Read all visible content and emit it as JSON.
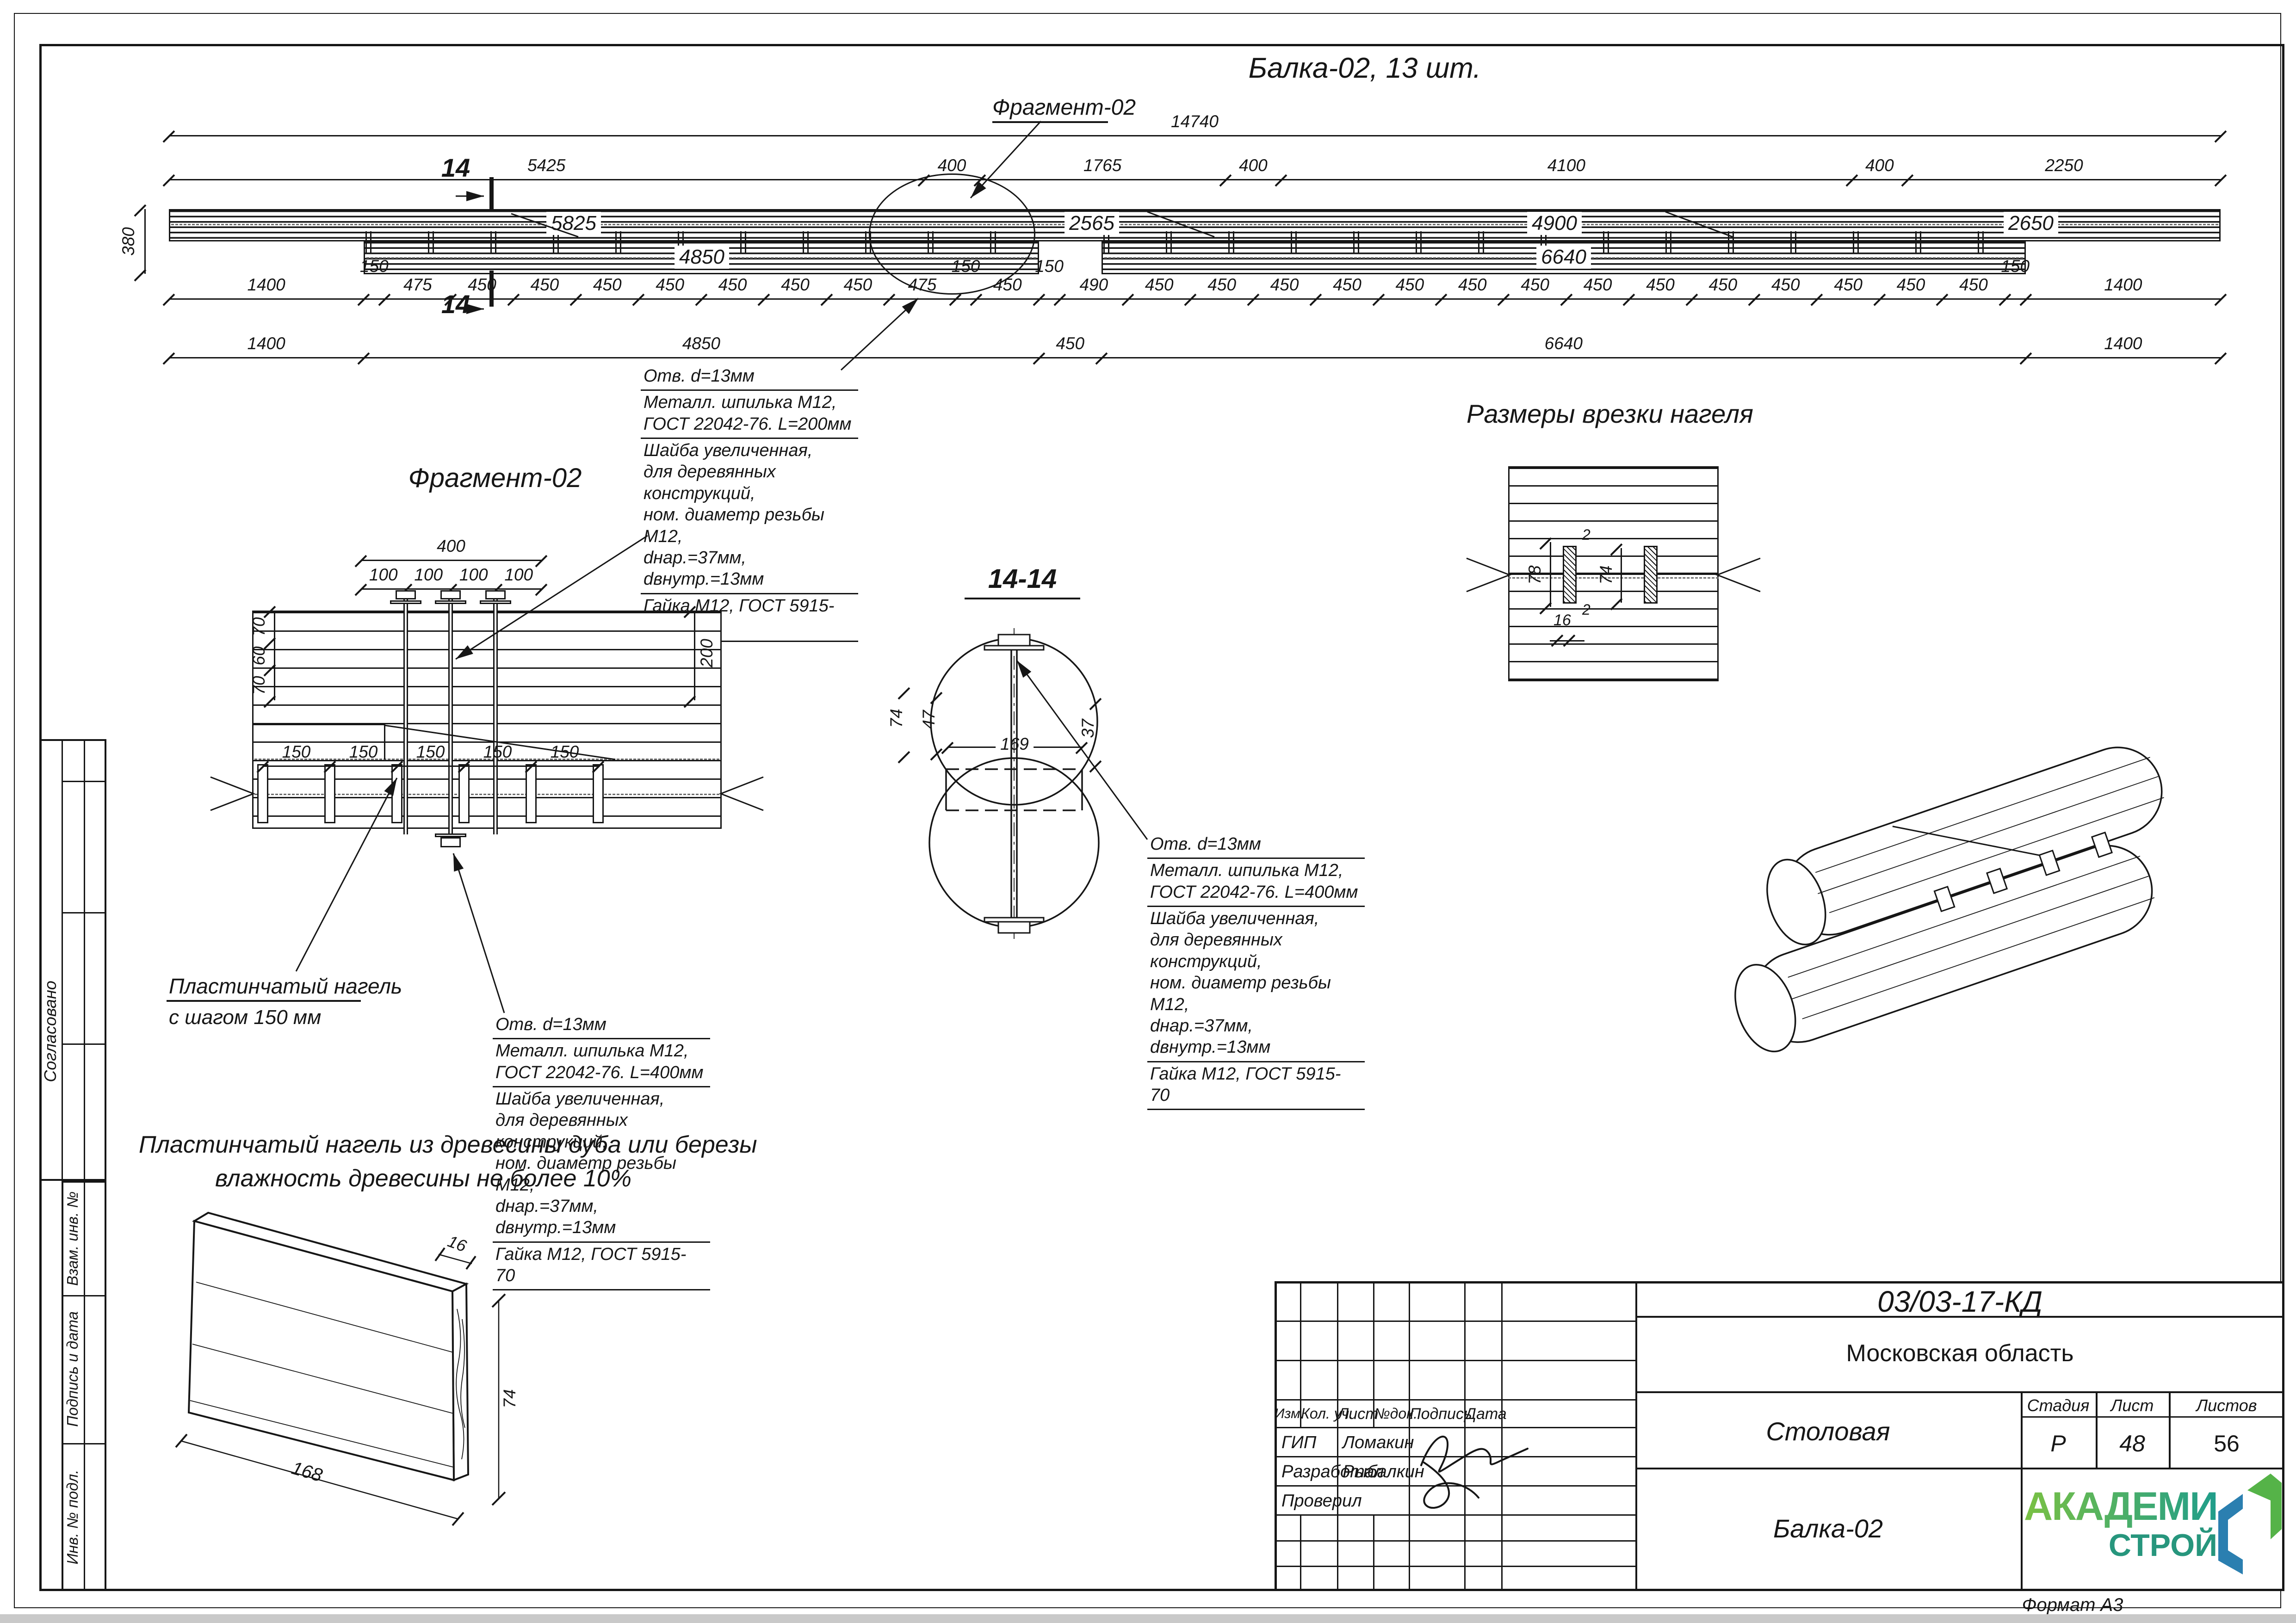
{
  "sheet": {
    "format": "Формат А3"
  },
  "main_view": {
    "title": "Балка-02, 13 шт.",
    "fragment_label": "Фрагмент-02",
    "section_mark": "14",
    "dim_overall": [
      "14740"
    ],
    "dim_top": [
      "5425",
      "400",
      "1765",
      "400",
      "4100",
      "400",
      "2250"
    ],
    "dim_fine": [
      "1400",
      "150",
      "475",
      "450",
      "450",
      "450",
      "450",
      "450",
      "450",
      "450",
      "475",
      "150",
      "450",
      "150",
      "490",
      "450",
      "450",
      "450",
      "450",
      "450",
      "450",
      "450",
      "450",
      "450",
      "450",
      "450",
      "450",
      "450",
      "450",
      "150",
      "1400"
    ],
    "dim_bottom": [
      "1400",
      "4850",
      "450",
      "6640",
      "1400"
    ],
    "height_dim": "380",
    "top_beam_labels": [
      "5825",
      "2565",
      "4900",
      "2650"
    ],
    "bottom_beam_labels": [
      "4850",
      "6640"
    ]
  },
  "callout_l200": {
    "lines": [
      "Отв. d=13мм",
      "Металл. шпилька М12,",
      "ГОСТ 22042-76. L=200мм",
      "Шайба увеличенная,",
      "для деревянных конструкций,",
      "ном. диаметр резьбы М12,",
      "dнар.=37мм, dвнутр.=13мм",
      "Гайка М12, ГОСТ 5915-70"
    ]
  },
  "callout_l400_a": {
    "lines": [
      "Отв. d=13мм",
      "Металл. шпилька М12,",
      "ГОСТ 22042-76. L=400мм",
      "Шайба увеличенная,",
      "для деревянных конструкций,",
      "ном. диаметр резьбы М12,",
      "dнар.=37мм, dвнутр.=13мм",
      "Гайка М12, ГОСТ 5915-70"
    ]
  },
  "callout_l400_b": {
    "lines": [
      "Отв. d=13мм",
      "Металл. шпилька М12,",
      "ГОСТ 22042-76. L=400мм",
      "Шайба увеличенная,",
      "для деревянных конструкций,",
      "ном. диаметр резьбы М12,",
      "dнар.=37мм, dвнутр.=13мм",
      "Гайка М12, ГОСТ 5915-70"
    ]
  },
  "fragment_view": {
    "title": "Фрагмент-02",
    "dim_400": [
      "400"
    ],
    "dim_100": [
      "100",
      "100",
      "100",
      "100"
    ],
    "dim_150": [
      "150",
      "150",
      "150",
      "150",
      "150"
    ],
    "dim_70a": "70",
    "dim_60": "60",
    "dim_70b": "70",
    "dim_200": "200",
    "note_line1": "Пластинчатый нагель",
    "note_line2": "с шагом 150 мм"
  },
  "section_view": {
    "title": "14-14",
    "dim_169": [
      "169"
    ],
    "dim_74": "74",
    "dim_47": "47",
    "dim_37": "37"
  },
  "notch_view": {
    "title": "Размеры врезки нагеля",
    "dim_78": "78",
    "dim_74": "74",
    "dim_2_top": "2",
    "dim_2_bottom": "2",
    "dim_16": "16"
  },
  "plank_view": {
    "note_line1": "Пластинчатый нагель из древесины дуба или березы",
    "note_line2": "влажность древесины не более 10%",
    "dim_16": "16",
    "dim_74": "74",
    "dim_168": "168"
  },
  "side_stamps": {
    "approved": "Согласовано",
    "subst": "Взам. инв. №",
    "sign_date": "Подпись и дата",
    "inv": "Инв. № подл."
  },
  "title_block": {
    "doc_number": "03/03-17-КД",
    "region": "Московская область",
    "object_name": "Столовая",
    "drawing_name": "Балка-02",
    "headers": [
      "Изм.",
      "Кол. уч.",
      "Лист",
      "№док.",
      "Подпись",
      "Дата"
    ],
    "rows": [
      {
        "role": "ГИП",
        "name": "Ломакин"
      },
      {
        "role": "Разработал",
        "name": "Рыбалкин"
      },
      {
        "role": "Проверил",
        "name": ""
      }
    ],
    "stage_label": "Стадия",
    "sheet_label": "Лист",
    "sheets_label": "Листов",
    "stage": "Р",
    "sheet_no": "48",
    "sheets_total": "56",
    "logo_top": "АКАДЕМИК",
    "logo_bottom": "СТРОЙ",
    "logo_colors": {
      "green": "#55b348",
      "teal": "#27967d",
      "blue": "#2b7fb0"
    }
  }
}
